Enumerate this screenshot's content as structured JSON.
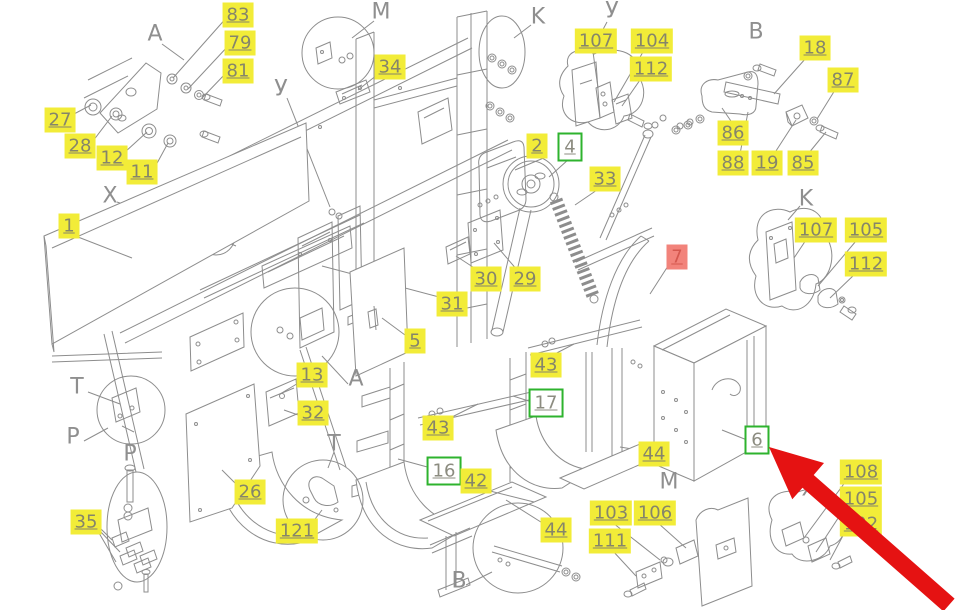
{
  "drawing": {
    "type": "exploded-parts-diagram"
  },
  "colors": {
    "label_yellow_bg": "#f2ec38",
    "label_text": "#85856a",
    "label_green_border": "#2eb32e",
    "label_red_bg": "#f2837b",
    "label_red_text": "#d4574e",
    "line_gray": "#8d8d8d",
    "arrow_red": "#e51212"
  },
  "part_labels": [
    {
      "text": "83",
      "x": 238,
      "y": 15,
      "style": "yellow"
    },
    {
      "text": "79",
      "x": 240,
      "y": 43,
      "style": "yellow"
    },
    {
      "text": "81",
      "x": 238,
      "y": 71,
      "style": "yellow"
    },
    {
      "text": "27",
      "x": 60,
      "y": 120,
      "style": "yellow"
    },
    {
      "text": "28",
      "x": 80,
      "y": 146,
      "style": "yellow"
    },
    {
      "text": "12",
      "x": 112,
      "y": 158,
      "style": "yellow"
    },
    {
      "text": "11",
      "x": 142,
      "y": 172,
      "style": "yellow"
    },
    {
      "text": "1",
      "x": 69,
      "y": 226,
      "style": "yellow"
    },
    {
      "text": "34",
      "x": 390,
      "y": 67,
      "style": "yellow"
    },
    {
      "text": "107",
      "x": 596,
      "y": 41,
      "style": "yellow"
    },
    {
      "text": "104",
      "x": 652,
      "y": 41,
      "style": "yellow"
    },
    {
      "text": "112",
      "x": 651,
      "y": 69,
      "style": "yellow"
    },
    {
      "text": "18",
      "x": 815,
      "y": 48,
      "style": "yellow"
    },
    {
      "text": "87",
      "x": 843,
      "y": 80,
      "style": "yellow"
    },
    {
      "text": "86",
      "x": 733,
      "y": 133,
      "style": "yellow"
    },
    {
      "text": "88",
      "x": 733,
      "y": 163,
      "style": "yellow"
    },
    {
      "text": "19",
      "x": 767,
      "y": 163,
      "style": "yellow"
    },
    {
      "text": "85",
      "x": 803,
      "y": 163,
      "style": "yellow"
    },
    {
      "text": "107",
      "x": 816,
      "y": 230,
      "style": "yellow"
    },
    {
      "text": "105",
      "x": 866,
      "y": 230,
      "style": "yellow"
    },
    {
      "text": "112",
      "x": 866,
      "y": 264,
      "style": "yellow"
    },
    {
      "text": "2",
      "x": 537,
      "y": 146,
      "style": "yellow"
    },
    {
      "text": "4",
      "x": 570,
      "y": 147,
      "style": "green"
    },
    {
      "text": "33",
      "x": 605,
      "y": 179,
      "style": "yellow"
    },
    {
      "text": "7",
      "x": 677,
      "y": 257,
      "style": "red"
    },
    {
      "text": "30",
      "x": 486,
      "y": 279,
      "style": "yellow"
    },
    {
      "text": "29",
      "x": 525,
      "y": 279,
      "style": "yellow"
    },
    {
      "text": "31",
      "x": 452,
      "y": 304,
      "style": "yellow"
    },
    {
      "text": "5",
      "x": 415,
      "y": 341,
      "style": "yellow"
    },
    {
      "text": "43",
      "x": 546,
      "y": 365,
      "style": "yellow"
    },
    {
      "text": "17",
      "x": 546,
      "y": 403,
      "style": "green"
    },
    {
      "text": "13",
      "x": 312,
      "y": 375,
      "style": "yellow"
    },
    {
      "text": "32",
      "x": 313,
      "y": 413,
      "style": "yellow"
    },
    {
      "text": "43",
      "x": 438,
      "y": 428,
      "style": "yellow"
    },
    {
      "text": "16",
      "x": 444,
      "y": 471,
      "style": "green"
    },
    {
      "text": "42",
      "x": 476,
      "y": 481,
      "style": "yellow"
    },
    {
      "text": "44",
      "x": 654,
      "y": 454,
      "style": "yellow"
    },
    {
      "text": "6",
      "x": 757,
      "y": 440,
      "style": "green"
    },
    {
      "text": "26",
      "x": 250,
      "y": 492,
      "style": "yellow"
    },
    {
      "text": "121",
      "x": 297,
      "y": 531,
      "style": "yellow"
    },
    {
      "text": "35",
      "x": 86,
      "y": 522,
      "style": "yellow"
    },
    {
      "text": "44",
      "x": 556,
      "y": 530,
      "style": "yellow"
    },
    {
      "text": "103",
      "x": 611,
      "y": 513,
      "style": "yellow"
    },
    {
      "text": "106",
      "x": 655,
      "y": 513,
      "style": "yellow"
    },
    {
      "text": "111",
      "x": 610,
      "y": 541,
      "style": "yellow"
    },
    {
      "text": "108",
      "x": 861,
      "y": 472,
      "style": "yellow"
    },
    {
      "text": "105",
      "x": 861,
      "y": 499,
      "style": "yellow"
    },
    {
      "text": "102",
      "x": 861,
      "y": 524,
      "style": "yellow"
    }
  ],
  "view_letters": [
    {
      "text": "A",
      "x": 155,
      "y": 34
    },
    {
      "text": "У",
      "x": 281,
      "y": 89
    },
    {
      "text": "M",
      "x": 381,
      "y": 12
    },
    {
      "text": "K",
      "x": 538,
      "y": 17
    },
    {
      "text": "У",
      "x": 612,
      "y": 11
    },
    {
      "text": "B",
      "x": 756,
      "y": 32
    },
    {
      "text": "X",
      "x": 110,
      "y": 196
    },
    {
      "text": "K",
      "x": 806,
      "y": 199
    },
    {
      "text": "A",
      "x": 356,
      "y": 379
    },
    {
      "text": "T",
      "x": 77,
      "y": 387
    },
    {
      "text": "P",
      "x": 73,
      "y": 437
    },
    {
      "text": "P",
      "x": 130,
      "y": 454
    },
    {
      "text": "T",
      "x": 334,
      "y": 444
    },
    {
      "text": "M",
      "x": 669,
      "y": 482
    },
    {
      "text": "B",
      "x": 459,
      "y": 581
    },
    {
      "text": "X",
      "x": 809,
      "y": 489
    }
  ],
  "annotation_arrow": {
    "points_to": "6",
    "color": "#e51212"
  }
}
